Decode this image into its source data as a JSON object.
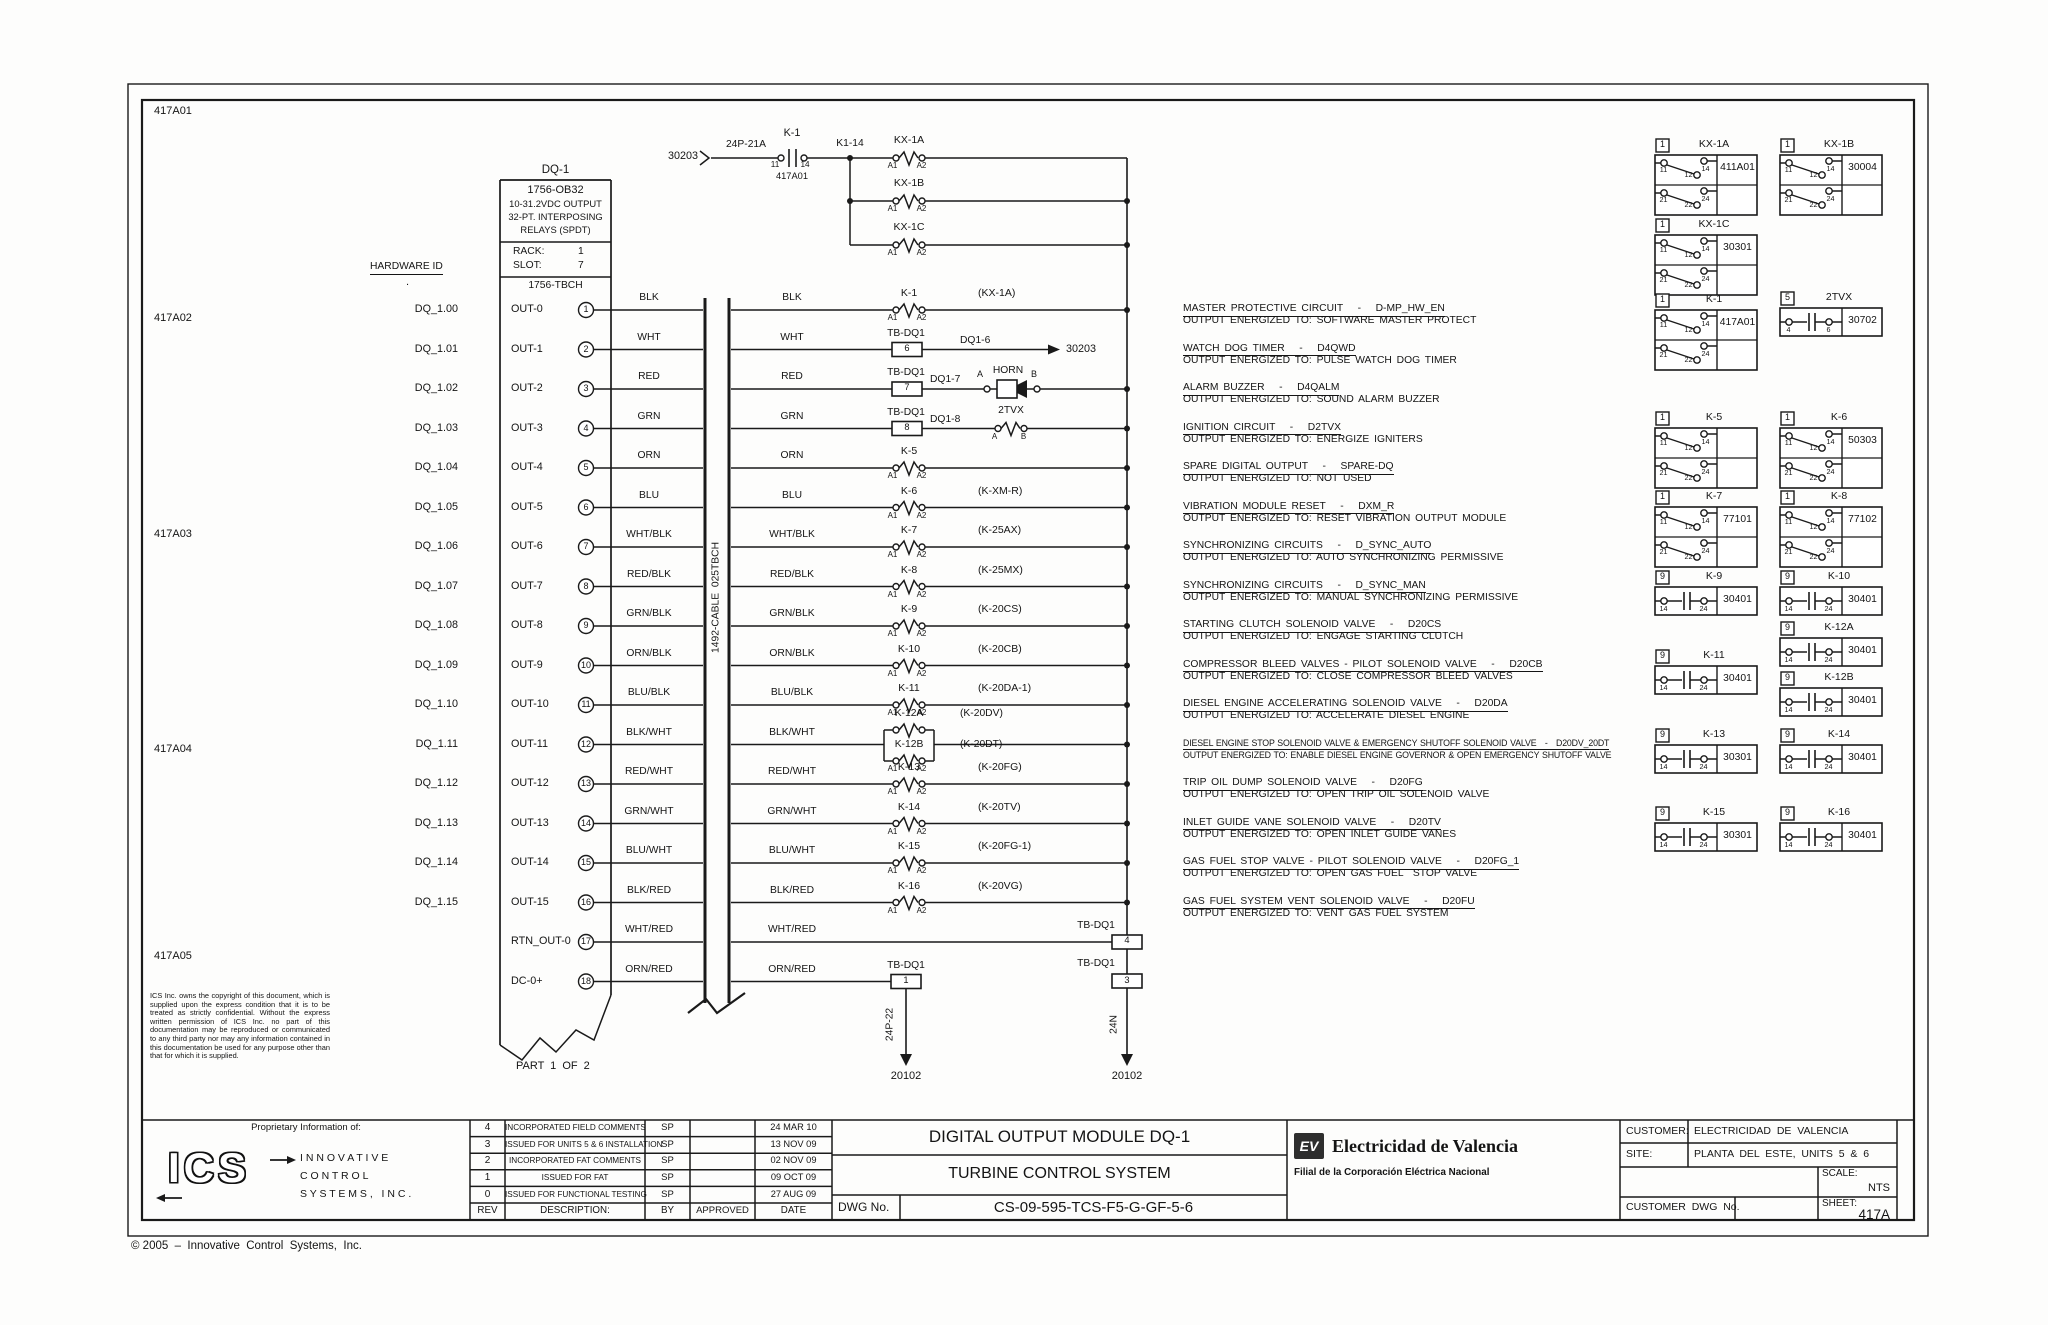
{
  "sheet": {
    "zone_labels": [
      "417A01",
      "417A02",
      "417A03",
      "417A04",
      "417A05"
    ],
    "copyright": "© 2005  –  Innovative  Control  Systems,  Inc.",
    "part_note": "PART 1 OF 2"
  },
  "module": {
    "name": "DQ-1",
    "model": "1756-OB32",
    "spec_lines": [
      "10-31.2VDC OUTPUT",
      "32-PT. INTERPOSING",
      "RELAYS (SPDT)"
    ],
    "rack_label": "RACK:",
    "rack": "1",
    "slot_label": "SLOT:",
    "slot": "7",
    "terminal_base": "1756-TBCH",
    "hardware_id_header": "HARDWARE ID",
    "header_dot": "."
  },
  "cable": {
    "label": "1492-CABLE  025TBCH"
  },
  "feed": {
    "source": "30203",
    "wire_label": "24P-21A",
    "contact": "K-1",
    "pin_left": "11",
    "pin_right": "14",
    "ref": "417A01",
    "junction": "K1-14"
  },
  "top_branch": {
    "coils": [
      {
        "name": "KX-1A"
      },
      {
        "name": "KX-1B"
      },
      {
        "name": "KX-1C"
      }
    ]
  },
  "symbols": {
    "coil_pins": [
      "A1",
      "A2"
    ],
    "spdt_top": [
      "11",
      "12",
      "14"
    ],
    "spdt_bottom": [
      "21",
      "22",
      "24"
    ],
    "no_pins": [
      "14",
      "24"
    ],
    "tvx_pins": [
      "4",
      "6"
    ]
  },
  "channels": [
    {
      "hardware_id": "DQ_1.00",
      "out": "OUT-0",
      "terminal": "1",
      "color": "BLK",
      "device": "coil",
      "coil": "K-1",
      "alias": "(KX-1A)"
    },
    {
      "hardware_id": "DQ_1.01",
      "out": "OUT-1",
      "terminal": "2",
      "color": "WHT",
      "device": "tb_arrow",
      "tb": "TB-DQ1",
      "tb_num": "6",
      "wire_tag": "DQ1-6",
      "dest": "30203"
    },
    {
      "hardware_id": "DQ_1.02",
      "out": "OUT-2",
      "terminal": "3",
      "color": "RED",
      "device": "horn",
      "tb": "TB-DQ1",
      "tb_num": "7",
      "wire_tag": "DQ1-7",
      "horn": "HORN",
      "pin_a": "A",
      "pin_b": "B"
    },
    {
      "hardware_id": "DQ_1.03",
      "out": "OUT-3",
      "terminal": "4",
      "color": "GRN",
      "device": "tvx",
      "tb": "TB-DQ1",
      "tb_num": "8",
      "wire_tag": "DQ1-8",
      "coil": "2TVX",
      "pin_a": "A",
      "pin_b": "B"
    },
    {
      "hardware_id": "DQ_1.04",
      "out": "OUT-4",
      "terminal": "5",
      "color": "ORN",
      "device": "coil",
      "coil": "K-5",
      "alias": ""
    },
    {
      "hardware_id": "DQ_1.05",
      "out": "OUT-5",
      "terminal": "6",
      "color": "BLU",
      "device": "coil",
      "coil": "K-6",
      "alias": "(K-XM-R)"
    },
    {
      "hardware_id": "DQ_1.06",
      "out": "OUT-6",
      "terminal": "7",
      "color": "WHT/BLK",
      "device": "coil",
      "coil": "K-7",
      "alias": "(K-25AX)"
    },
    {
      "hardware_id": "DQ_1.07",
      "out": "OUT-7",
      "terminal": "8",
      "color": "RED/BLK",
      "device": "coil",
      "coil": "K-8",
      "alias": "(K-25MX)"
    },
    {
      "hardware_id": "DQ_1.08",
      "out": "OUT-8",
      "terminal": "9",
      "color": "GRN/BLK",
      "device": "coil",
      "coil": "K-9",
      "alias": "(K-20CS)"
    },
    {
      "hardware_id": "DQ_1.09",
      "out": "OUT-9",
      "terminal": "10",
      "color": "ORN/BLK",
      "device": "coil",
      "coil": "K-10",
      "alias": "(K-20CB)"
    },
    {
      "hardware_id": "DQ_1.10",
      "out": "OUT-10",
      "terminal": "11",
      "color": "BLU/BLK",
      "device": "coil",
      "coil": "K-11",
      "alias": "(K-20DA-1)"
    },
    {
      "hardware_id": "DQ_1.11",
      "out": "OUT-11",
      "terminal": "12",
      "color": "BLK/WHT",
      "device": "dual",
      "coil_a": "K-12A",
      "alias_a": "(K-20DV)",
      "coil_b": "K-12B",
      "alias_b": "(K-20DT)"
    },
    {
      "hardware_id": "DQ_1.12",
      "out": "OUT-12",
      "terminal": "13",
      "color": "RED/WHT",
      "device": "coil",
      "coil": "K-13",
      "alias": "(K-20FG)"
    },
    {
      "hardware_id": "DQ_1.13",
      "out": "OUT-13",
      "terminal": "14",
      "color": "GRN/WHT",
      "device": "coil",
      "coil": "K-14",
      "alias": "(K-20TV)"
    },
    {
      "hardware_id": "DQ_1.14",
      "out": "OUT-14",
      "terminal": "15",
      "color": "BLU/WHT",
      "device": "coil",
      "coil": "K-15",
      "alias": "(K-20FG-1)"
    },
    {
      "hardware_id": "DQ_1.15",
      "out": "OUT-15",
      "terminal": "16",
      "color": "BLK/RED",
      "device": "coil",
      "coil": "K-16",
      "alias": "(K-20VG)"
    },
    {
      "hardware_id": "",
      "out": "RTN_OUT-0",
      "terminal": "17",
      "color": "WHT/RED",
      "device": "tb_bus",
      "tb": "TB-DQ1",
      "tb_num": "4"
    },
    {
      "hardware_id": "",
      "out": "DC-0+",
      "terminal": "18",
      "color": "ORN/RED",
      "device": "tb_down",
      "tb": "TB-DQ1",
      "tb_num": "1",
      "drop_tag": "24P-22",
      "dest": "20102"
    }
  ],
  "bus_bottom": {
    "tb": "TB-DQ1",
    "tb_num": "3",
    "drop_tag": "24N",
    "dest": "20102"
  },
  "descriptions": [
    {
      "title": "MASTER PROTECTIVE CIRCUIT   -   D-MP_HW_EN",
      "detail": "OUTPUT ENERGIZED TO: SOFTWARE MASTER PROTECT"
    },
    {
      "title": "WATCH DOG TIMER   -   D4QWD",
      "detail": "OUTPUT ENERGIZED TO: PULSE WATCH DOG TIMER"
    },
    {
      "title": "ALARM BUZZER   -   D4QALM",
      "detail": "OUTPUT ENERGIZED TO: SOUND ALARM BUZZER"
    },
    {
      "title": "IGNITION CIRCUIT   -   D2TVX",
      "detail": "OUTPUT ENERGIZED TO: ENERGIZE IGNITERS"
    },
    {
      "title": "SPARE DIGITAL OUTPUT   -   SPARE-DQ",
      "detail": "OUTPUT ENERGIZED TO: NOT USED"
    },
    {
      "title": "VIBRATION MODULE RESET   -   DXM_R",
      "detail": "OUTPUT ENERGIZED TO: RESET VIBRATION OUTPUT MODULE"
    },
    {
      "title": "SYNCHRONIZING CIRCUITS   -   D_SYNC_AUTO",
      "detail": "OUTPUT ENERGIZED TO: AUTO SYNCHRONIZING PERMISSIVE"
    },
    {
      "title": "SYNCHRONIZING CIRCUITS   -   D_SYNC_MAN",
      "detail": "OUTPUT ENERGIZED TO: MANUAL SYNCHRONIZING PERMISSIVE"
    },
    {
      "title": "STARTING CLUTCH SOLENOID VALVE   -   D20CS",
      "detail": "OUTPUT ENERGIZED TO: ENGAGE STARTING CLUTCH"
    },
    {
      "title": "COMPRESSOR BLEED VALVES - PILOT SOLENOID VALVE   -   D20CB",
      "detail": "OUTPUT ENERGIZED TO: CLOSE COMPRESSOR BLEED VALVES"
    },
    {
      "title": "DIESEL ENGINE ACCELERATING SOLENOID VALVE   -   D20DA",
      "detail": "OUTPUT ENERGIZED TO: ACCELERATE DIESEL ENGINE"
    },
    {
      "title": "DIESEL ENGINE STOP SOLENOID VALVE & EMERGENCY SHUTOFF SOLENOID VALVE   -   D20DV_20DT",
      "detail": "OUTPUT ENERGIZED TO: ENABLE DIESEL ENGINE GOVERNOR & OPEN EMERGENCY SHUTOFF VALVE"
    },
    {
      "title": "TRIP OIL DUMP SOLENOID VALVE   -   D20FG",
      "detail": "OUTPUT ENERGIZED TO: OPEN TRIP OIL SOLENOID VALVE"
    },
    {
      "title": "INLET GUIDE VANE SOLENOID VALVE   -   D20TV",
      "detail": "OUTPUT ENERGIZED TO: OPEN INLET GUIDE VANES"
    },
    {
      "title": "GAS FUEL STOP VALVE - PILOT SOLENOID VALVE   -   D20FG_1",
      "detail": "OUTPUT ENERGIZED TO: OPEN GAS FUEL  STOP VALVE"
    },
    {
      "title": "GAS FUEL SYSTEM VENT SOLENOID VALVE   -   D20FU",
      "detail": "OUTPUT ENERGIZED TO: VENT GAS FUEL SYSTEM"
    }
  ],
  "relay_table": {
    "col1": [
      {
        "badge": "1",
        "name": "KX-1A",
        "ref": "411A01",
        "type": "spdt"
      },
      {
        "badge": "1",
        "name": "KX-1C",
        "ref": "30301",
        "type": "spdt"
      },
      {
        "badge": "1",
        "name": "K-1",
        "ref": "417A01",
        "type": "spdt"
      },
      {
        "badge": "1",
        "name": "K-5",
        "ref": "",
        "type": "spdt"
      },
      {
        "badge": "1",
        "name": "K-7",
        "ref": "77101",
        "type": "spdt"
      },
      {
        "badge": "9",
        "name": "K-9",
        "ref": "30401",
        "type": "no"
      },
      {
        "badge": "9",
        "name": "K-11",
        "ref": "30401",
        "type": "no"
      },
      {
        "badge": "9",
        "name": "K-13",
        "ref": "30301",
        "type": "no"
      },
      {
        "badge": "9",
        "name": "K-15",
        "ref": "30301",
        "type": "no"
      }
    ],
    "col2": [
      {
        "badge": "1",
        "name": "KX-1B",
        "ref": "30004",
        "type": "spdt"
      },
      {
        "badge": "5",
        "name": "2TVX",
        "ref": "30702",
        "type": "tvx"
      },
      {
        "badge": "1",
        "name": "K-6",
        "ref": "50303",
        "type": "spdt"
      },
      {
        "badge": "1",
        "name": "K-8",
        "ref": "77102",
        "type": "spdt"
      },
      {
        "badge": "9",
        "name": "K-10",
        "ref": "30401",
        "type": "no"
      },
      {
        "badge": "9",
        "name": "K-12A",
        "ref": "30401",
        "type": "no"
      },
      {
        "badge": "9",
        "name": "K-12B",
        "ref": "30401",
        "type": "no"
      },
      {
        "badge": "9",
        "name": "K-14",
        "ref": "30401",
        "type": "no"
      },
      {
        "badge": "9",
        "name": "K-16",
        "ref": "30401",
        "type": "no"
      }
    ]
  },
  "legal": "ICS Inc. owns the copyright of this document, which is supplied upon the express condition that it is to be treated as strictly confidential. Without the express written permission of ICS Inc. no part of this documentation may be reproduced or communicated to any third party nor may any information contained in this documentation be used for any purpose other than that for which it is supplied.",
  "title_block": {
    "proprietary_heading": "Proprietary Information of:",
    "ics_logo_text": "ICS",
    "company_lines": [
      "I N N O V A T I V E",
      "C O N T R O L",
      "S Y S T E M S ,   I N C ."
    ],
    "rev_table": {
      "headers": {
        "rev": "REV",
        "description": "DESCRIPTION:",
        "by": "BY",
        "approved": "APPROVED",
        "date": "DATE"
      },
      "rows": [
        {
          "rev": "4",
          "description": "INCORPORATED FIELD COMMENTS",
          "by": "SP",
          "approved": "",
          "date": "24 MAR 10"
        },
        {
          "rev": "3",
          "description": "ISSUED FOR UNITS 5 & 6 INSTALLATION",
          "by": "SP",
          "approved": "",
          "date": "13 NOV 09"
        },
        {
          "rev": "2",
          "description": "INCORPORATED FAT COMMENTS",
          "by": "SP",
          "approved": "",
          "date": "02 NOV 09"
        },
        {
          "rev": "1",
          "description": "ISSUED FOR FAT",
          "by": "SP",
          "approved": "",
          "date": "09 OCT 09"
        },
        {
          "rev": "0",
          "description": "ISSUED FOR FUNCTIONAL TESTING",
          "by": "SP",
          "approved": "",
          "date": "27 AUG 09"
        }
      ]
    },
    "title1": "DIGITAL OUTPUT MODULE DQ-1",
    "title2": "TURBINE CONTROL SYSTEM",
    "dwg_label": "DWG No.",
    "dwg_no": "CS-09-595-TCS-F5-G-GF-5-6",
    "ev_logo": "EV",
    "ev_name": "Electricidad de Valencia",
    "ev_sub": "Filial de la Corporación Eléctrica Nacional",
    "customer_label": "CUSTOMER:",
    "customer": "ELECTRICIDAD  DE  VALENCIA",
    "site_label": "SITE:",
    "site": "PLANTA  DEL  ESTE,  UNITS  5  &  6",
    "scale_label": "SCALE:",
    "scale": "NTS",
    "sheet_label": "SHEET:",
    "sheet": "417A",
    "customer_dwg_label": "CUSTOMER  DWG  No."
  }
}
